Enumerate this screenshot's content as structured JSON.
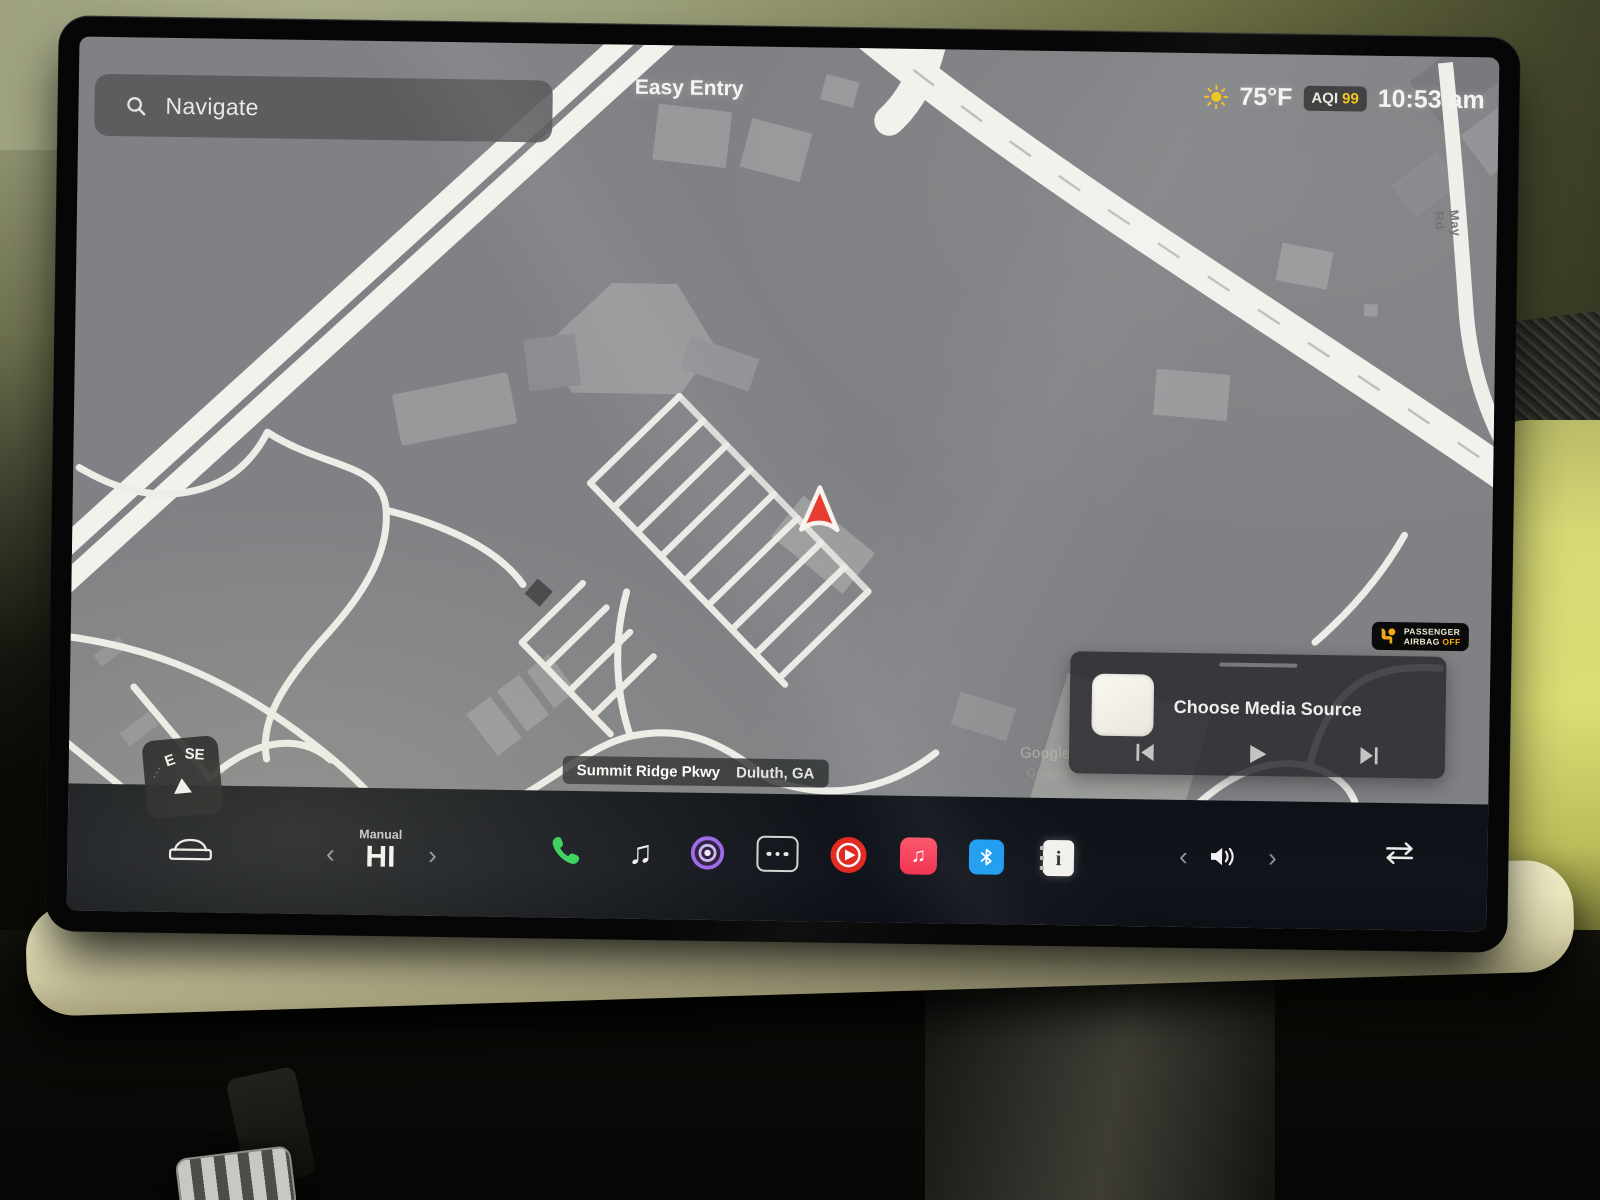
{
  "status_bar": {
    "search_placeholder": "Navigate",
    "profile_label": "Easy Entry",
    "temperature": "75°F",
    "aqi_label": "AQI",
    "aqi_value": "99",
    "time": "10:53 am"
  },
  "map": {
    "road_label": "May Rd",
    "watermark": "Google",
    "location_street": "Summit Ridge Pkwy",
    "location_city": "Duluth, GA",
    "compass_left": "E",
    "compass_right": "SE",
    "vehicle_marker": "red-navigation-arrow"
  },
  "airbag_warning": {
    "line1": "PASSENGER",
    "line2": "AIRBAG",
    "status_off": "OFF"
  },
  "media_player": {
    "title": "Choose Media Source",
    "controls": [
      "previous",
      "play",
      "next"
    ]
  },
  "climate": {
    "mode_label": "Manual",
    "temperature": "HI"
  },
  "dock_items": [
    "car-controls",
    "climate-temperature",
    "phone",
    "media-note",
    "podcast-app",
    "app-launcher",
    "youtube-music",
    "apple-music",
    "bluetooth",
    "release-notes",
    "volume",
    "source-swap"
  ],
  "icons": {
    "chevron_left": "‹",
    "chevron_right": "›",
    "music_note": "♫",
    "info_glyph": "i",
    "compass_dots": "···"
  },
  "colors": {
    "phone_green": "#2fd158",
    "bluetooth_blue": "#1e9cf0",
    "apple_music_pink": "#fb3c57",
    "youtube_music_red": "#e32a21",
    "app_purple": "#9a66e8",
    "aqi_yellow": "#f2c21c",
    "marker_red": "#e8392e",
    "map_bg": "#7f8184",
    "dock_bg": "#11141c"
  }
}
